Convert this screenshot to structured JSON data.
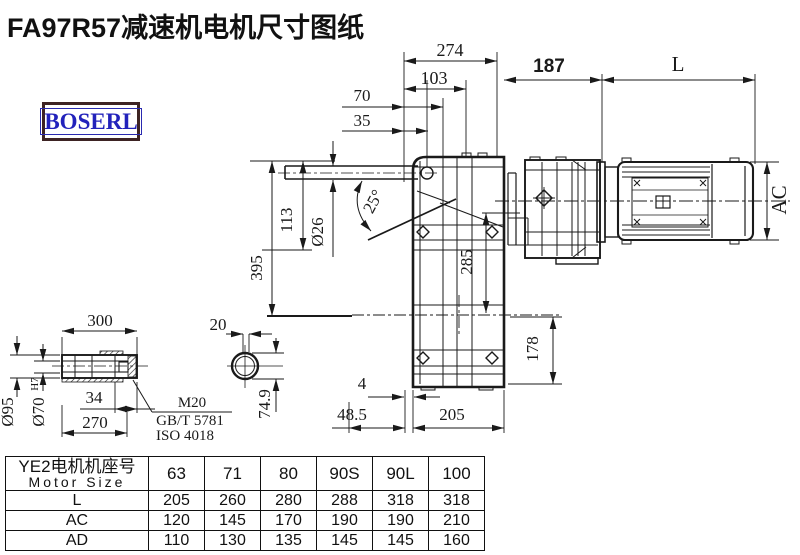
{
  "title": "FA97R57减速机电机尺寸图纸",
  "logo": {
    "text": "BOSERL",
    "text_color": "#2222bb",
    "border_color": "#3d2323"
  },
  "drawing": {
    "dims": {
      "d274": "274",
      "d103": "103",
      "d70": "70",
      "d35": "35",
      "d187": "187",
      "dL": "L",
      "dAC": "AC",
      "d395": "395",
      "d113": "113",
      "d26": "Ø26",
      "d25": "25°",
      "d285": "285",
      "d178": "178",
      "d4": "4",
      "d485": "48.5",
      "d205": "205",
      "d300": "300",
      "d95": "Ø95",
      "d70h7": "Ø70",
      "d70h7_sup": "H7",
      "d34": "34",
      "d270": "270",
      "d20": "20",
      "d749": "74.9",
      "m20": "M20",
      "gbt": "GB/T 5781",
      "iso": "ISO 4018"
    }
  },
  "table": {
    "header_cn": "YE2电机机座号",
    "header_en": "Motor Size",
    "sizes": [
      "63",
      "71",
      "80",
      "90S",
      "90L",
      "100"
    ],
    "rows": [
      {
        "label": "L",
        "values": [
          "205",
          "260",
          "280",
          "288",
          "318",
          "318"
        ]
      },
      {
        "label": "AC",
        "values": [
          "120",
          "145",
          "170",
          "190",
          "190",
          "210"
        ]
      },
      {
        "label": "AD",
        "values": [
          "110",
          "130",
          "135",
          "145",
          "145",
          "160"
        ]
      }
    ]
  },
  "colors": {
    "line": "#1a1a1a",
    "background": "#ffffff"
  }
}
